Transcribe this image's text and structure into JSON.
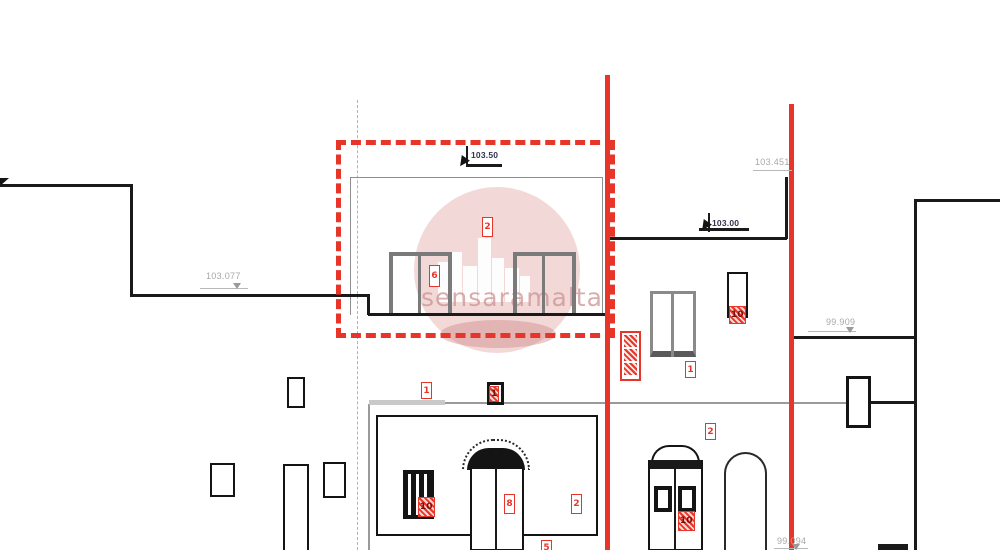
{
  "watermark": {
    "text": "sensaramalta"
  },
  "colors": {
    "accent_red": "#e8352a",
    "line_black": "#1a1a1a",
    "frame_gray": "#7a7a7a",
    "dim_gray": "#a8a8a8",
    "watermark_pink": "#e2b4b4"
  },
  "dimensions": {
    "left_parapet": "103.077",
    "upper_roof": "103.50",
    "neighbour_roof": "103.451",
    "middle_roof": "103.00",
    "right_parapet": "99.909",
    "ground_right": "99.094"
  },
  "tags": {
    "upper_wall": "2",
    "upper_window": "6",
    "mid_left_wall": "1",
    "vent": "1",
    "mid_window": "1",
    "narrow_window": "10",
    "mid_wall_right": "2",
    "facade_wall": "2",
    "main_door": "8",
    "louver": "10",
    "right_door": "10",
    "ground": "5"
  },
  "hatch_stack": {
    "count": "3"
  }
}
